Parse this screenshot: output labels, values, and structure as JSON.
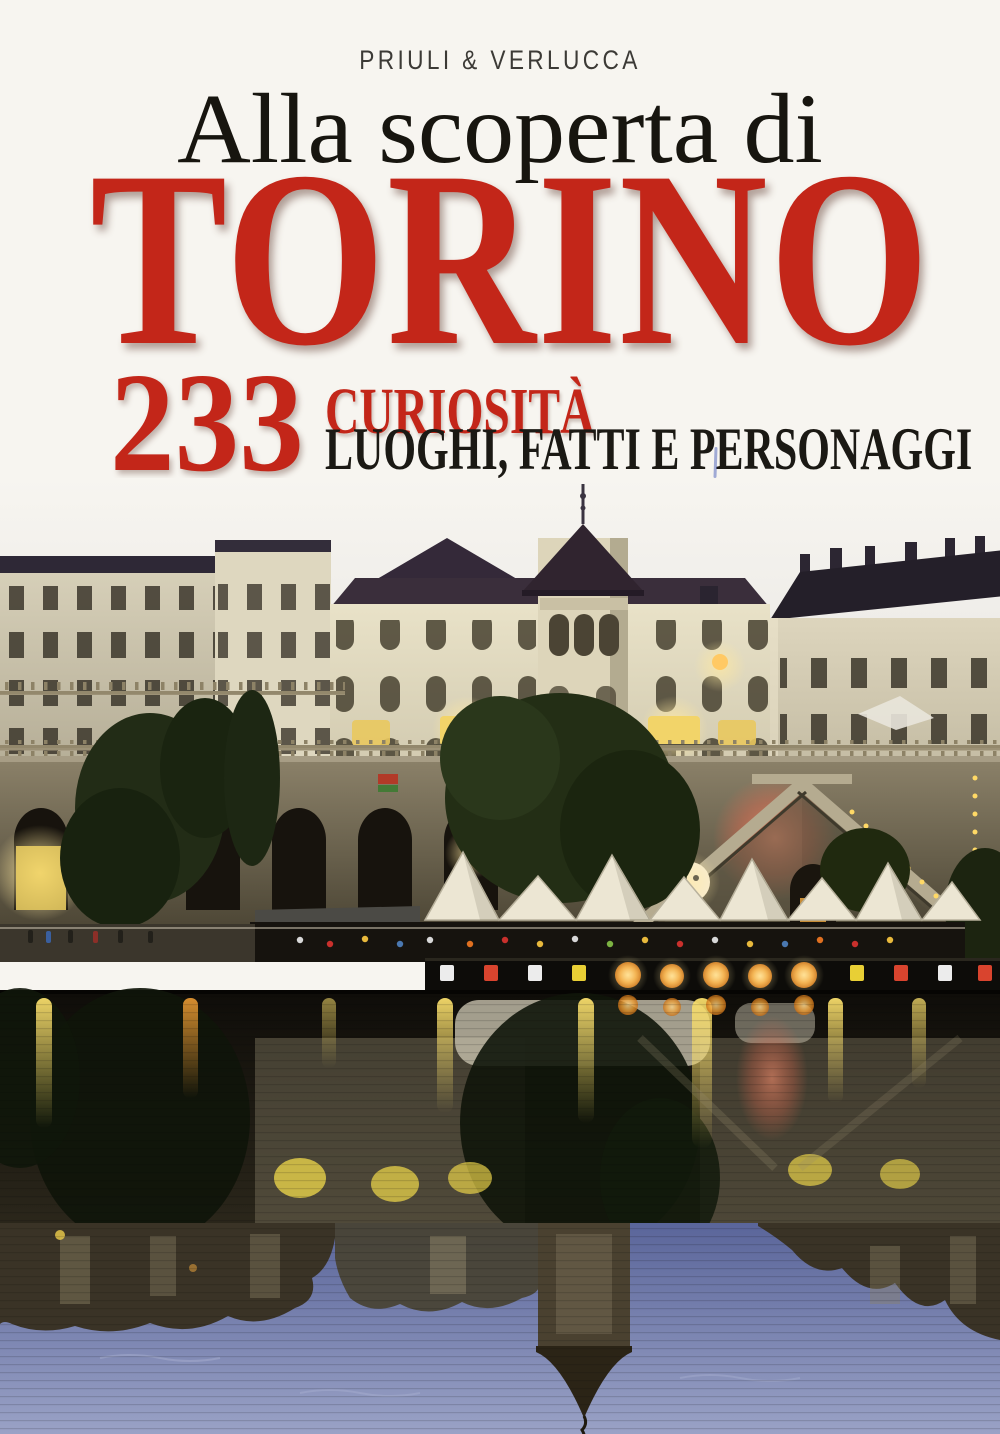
{
  "cover": {
    "publisher": "PRIULI & VERLUCCA",
    "title": {
      "line1": "Alla scoperta di",
      "line2": "TORINO"
    },
    "subtitle": {
      "count": "233",
      "line1": "CURIOSITÀ",
      "line2": "LUOGHI, FATTI E PERSONAGGI"
    },
    "colors": {
      "accent_red": "#c32619",
      "ink_black": "#17150f",
      "background": "#f7f5f0",
      "water_blue": "#7f88b4"
    },
    "photo": {
      "alt": "Evening photograph of Turin: historic palaces with a tower above the Murazzi embankment of the Po river, lit arches, white tents and lanterns, all mirrored in the water"
    }
  }
}
